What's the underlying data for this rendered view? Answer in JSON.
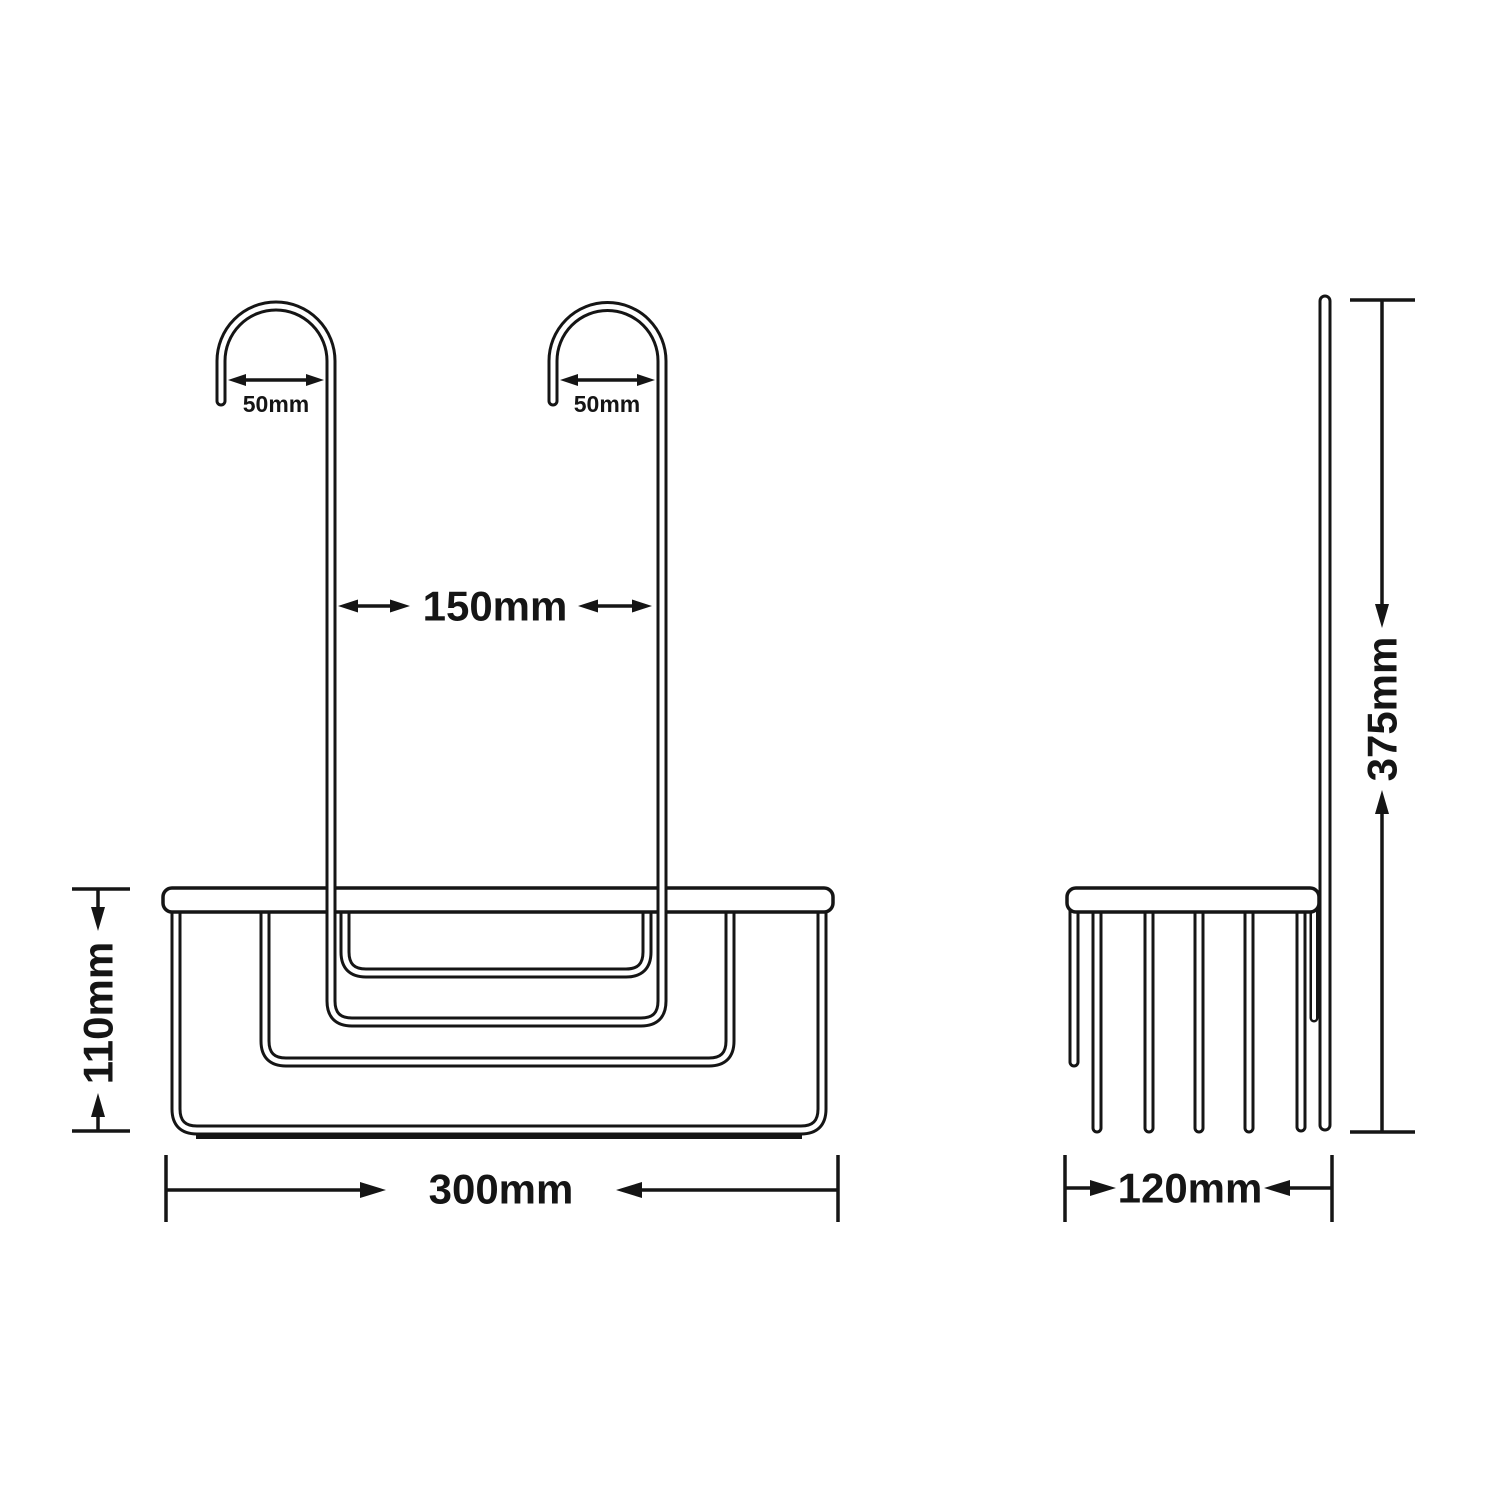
{
  "drawing": {
    "type": "technical-dimension-diagram",
    "subject": "hanging wire shower basket with two hooks, front and side elevation views",
    "colors": {
      "line": "#151515",
      "background": "#ffffff"
    },
    "front_view": {
      "hook1_width": "50mm",
      "hook2_width": "50mm",
      "hook_spacing": "150mm",
      "basket_height": "110mm",
      "basket_width": "300mm"
    },
    "side_view": {
      "overall_height": "375mm",
      "basket_depth": "120mm"
    }
  }
}
